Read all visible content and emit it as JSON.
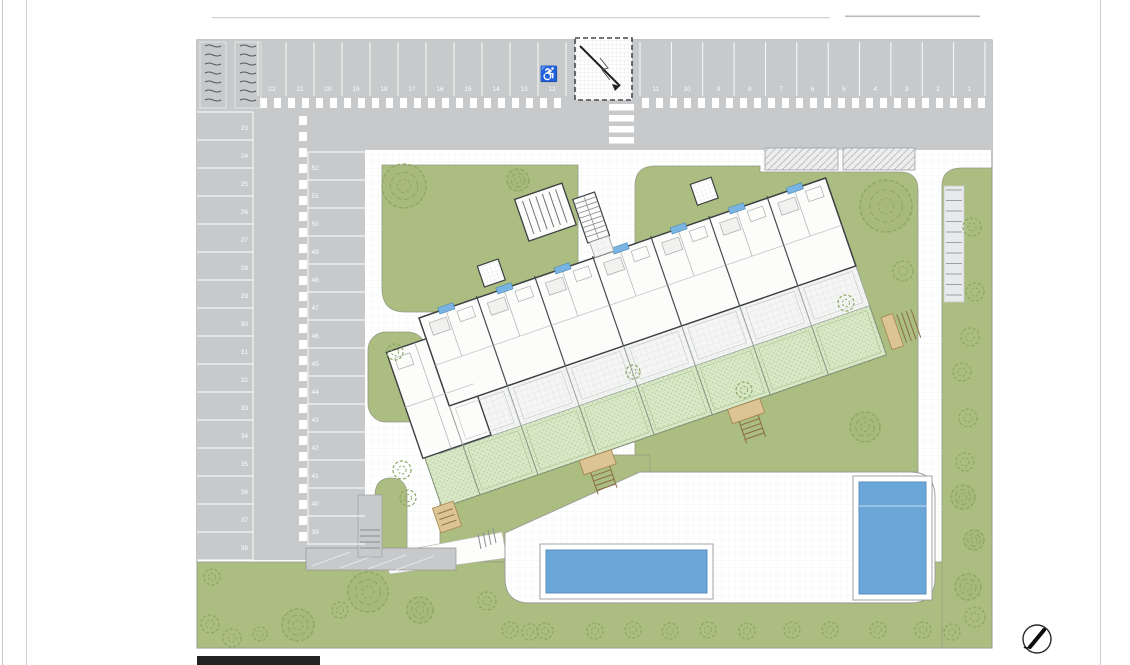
{
  "document": {
    "type": "architectural-site-plan",
    "description": "Ground-floor site plan of a tilted apartment block with numbered parking, lawns, private gardens and two swimming pools"
  },
  "colors": {
    "asphalt": "#c7c9cb",
    "stall_line": "#ffffff",
    "lawn": "#abbd80",
    "private_garden": "#d8e8c6",
    "pool_water": "#6aa7d8",
    "pool_edge": "#5b8fbc",
    "building_outline": "#3d4043",
    "terrace_paving": "#f5f6f4",
    "steps_wood": "#dcc494",
    "tree_stroke": "#8aa761",
    "page_line": "#cdd0d2"
  },
  "parking": {
    "row_top_left_numbers": [
      "22",
      "21",
      "20",
      "19",
      "18",
      "17",
      "16",
      "15",
      "14",
      "13",
      "12"
    ],
    "row_top_right_numbers": [
      "11",
      "10",
      "9",
      "8",
      "7",
      "6",
      "5",
      "4",
      "3",
      "2",
      "1"
    ],
    "column_west_numbers": [
      "23",
      "24",
      "25",
      "26",
      "27",
      "28",
      "29",
      "30",
      "31",
      "32",
      "33",
      "34",
      "35",
      "36",
      "37",
      "38"
    ],
    "column_inner_numbers": [
      "52",
      "51",
      "50",
      "49",
      "48",
      "47",
      "46",
      "45",
      "44",
      "43",
      "42",
      "41",
      "40",
      "39"
    ],
    "total_spaces": 52,
    "accessible_space_symbol": "♿"
  },
  "features": {
    "building_units_visible": 7,
    "pool_count": 2,
    "ramp_count": 2,
    "detached_pool_house": "louvered-technical-room",
    "exterior_stairwell": true,
    "crosswalk": true
  },
  "icons": {
    "wheelchair": "wheelchair-accessible-parking-icon",
    "north_arrow": "north-arrow-compass-icon",
    "tree": "tree-canopy-icon",
    "shrub": "shrub-icon"
  }
}
